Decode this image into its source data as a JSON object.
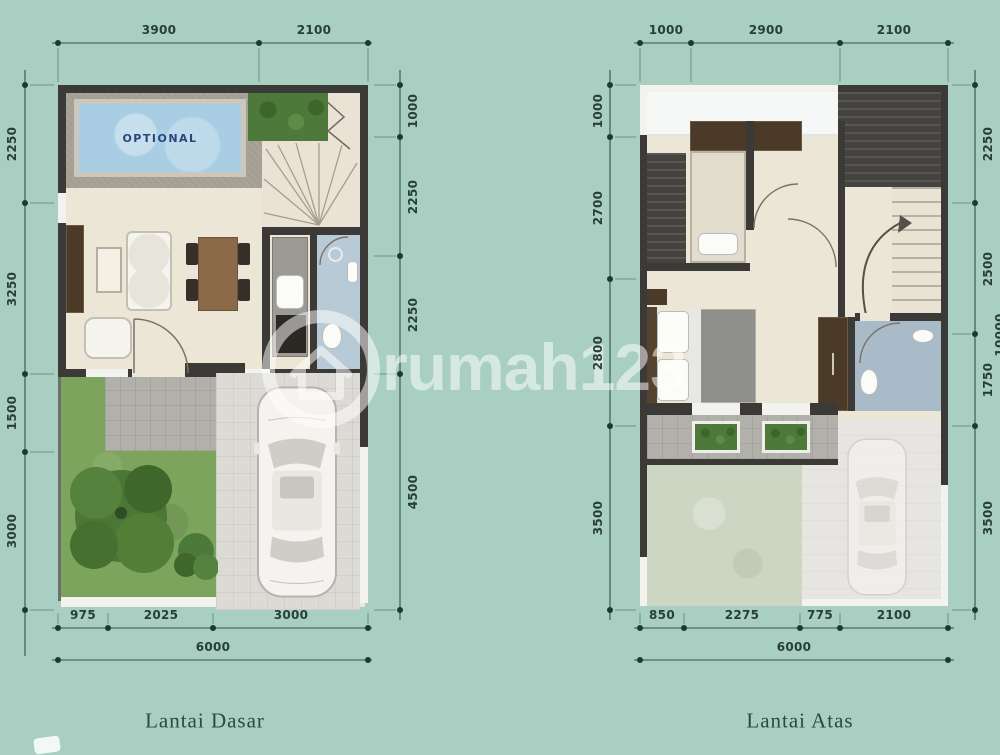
{
  "watermark": {
    "text": "rumah123"
  },
  "plans": {
    "ground": {
      "caption": "Lantai Dasar",
      "pool_label": "OPTIONAL",
      "dims_top": [
        "3900",
        "2100"
      ],
      "dims_left": [
        "2250",
        "3250",
        "1500",
        "3000"
      ],
      "dims_right": [
        "1000",
        "2250",
        "2250",
        "4500"
      ],
      "dims_bottom": [
        "975",
        "2025",
        "3000"
      ],
      "total_width": "6000"
    },
    "upper": {
      "caption": "Lantai Atas",
      "dims_top": [
        "1000",
        "2900",
        "2100"
      ],
      "dims_left": [
        "1000",
        "2700",
        "2800",
        "3500"
      ],
      "dims_right": [
        "2250",
        "2500",
        "1750",
        "3500"
      ],
      "dims_bottom": [
        "850",
        "2275",
        "775",
        "2100"
      ],
      "total_width": "6000",
      "total_height": "10000"
    }
  },
  "colors": {
    "bg": "#a8cfc2",
    "wall": "#3b3a37",
    "floor": "#ece6d7",
    "water": "#a9cde3",
    "deck": "#a49e93",
    "hedge": "#4d7a3b",
    "lawn": "#7ca45c",
    "lawnfade": "#ccd6c2",
    "patio": "#b2b0ab",
    "drive": "#dcdad4",
    "drivefade": "#e6e5e1",
    "bath": "#b7cad6",
    "bath2": "#a9bbc8",
    "roof": "#45433f",
    "wood": "#8b6a4a",
    "wooddark": "#4c3a28",
    "dimc": "#273f37",
    "capc": "#2c4a41"
  }
}
